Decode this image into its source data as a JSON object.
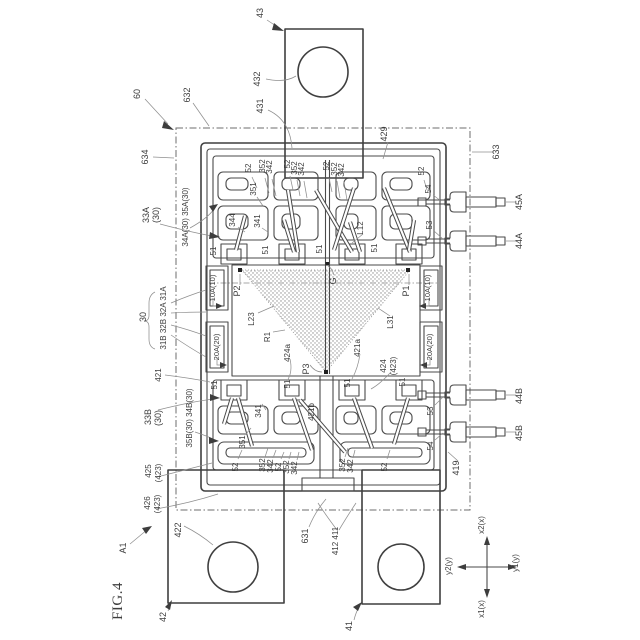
{
  "labels": {
    "fig": "FIG.4",
    "a1": "A1",
    "n60": "60",
    "n632": "632",
    "n633": "633",
    "n634": "634",
    "n631": "631",
    "n43": "43",
    "n432": "432",
    "n431": "431",
    "n429": "429",
    "n419": "419",
    "n41": "41",
    "n42": "42",
    "n422": "422",
    "n412411": "412 411",
    "n33a": "33A",
    "n30p": "(30)",
    "n34a35a": "34A(30) 35A(30)",
    "n33b": "33B",
    "n35b34b": "35B(30) 34B(30)",
    "n30": "30",
    "group31": "31B 32B 32A 31A",
    "n421": "421",
    "n421a": "421a",
    "n421b": "421b",
    "n424": "424",
    "n424a": "424a",
    "n423p": "(423)",
    "n425": "425",
    "n426": "426",
    "n10a": "10A(10)",
    "n20a": "20A(20)",
    "p1": "P1",
    "p2": "P2",
    "p3": "P3",
    "g": "G",
    "l12": "L12",
    "l23": "L23",
    "l31": "L31",
    "r1": "R1",
    "n45a": "45A",
    "n44a": "44A",
    "n44b": "44B",
    "n45b": "45B",
    "n51": "51",
    "n52": "52",
    "n53": "53",
    "n54": "54",
    "n341": "341",
    "n344": "344",
    "n351": "351",
    "n352": "352",
    "n342": "342",
    "x1": "x1(x)",
    "x2": "x2(x)",
    "y1": "y1(y)",
    "y2": "y2(y)"
  },
  "colors": {
    "line": "#4a4a4a",
    "text": "#3d3d3d",
    "background": "#ffffff",
    "stipple": "#8a8a8a"
  }
}
